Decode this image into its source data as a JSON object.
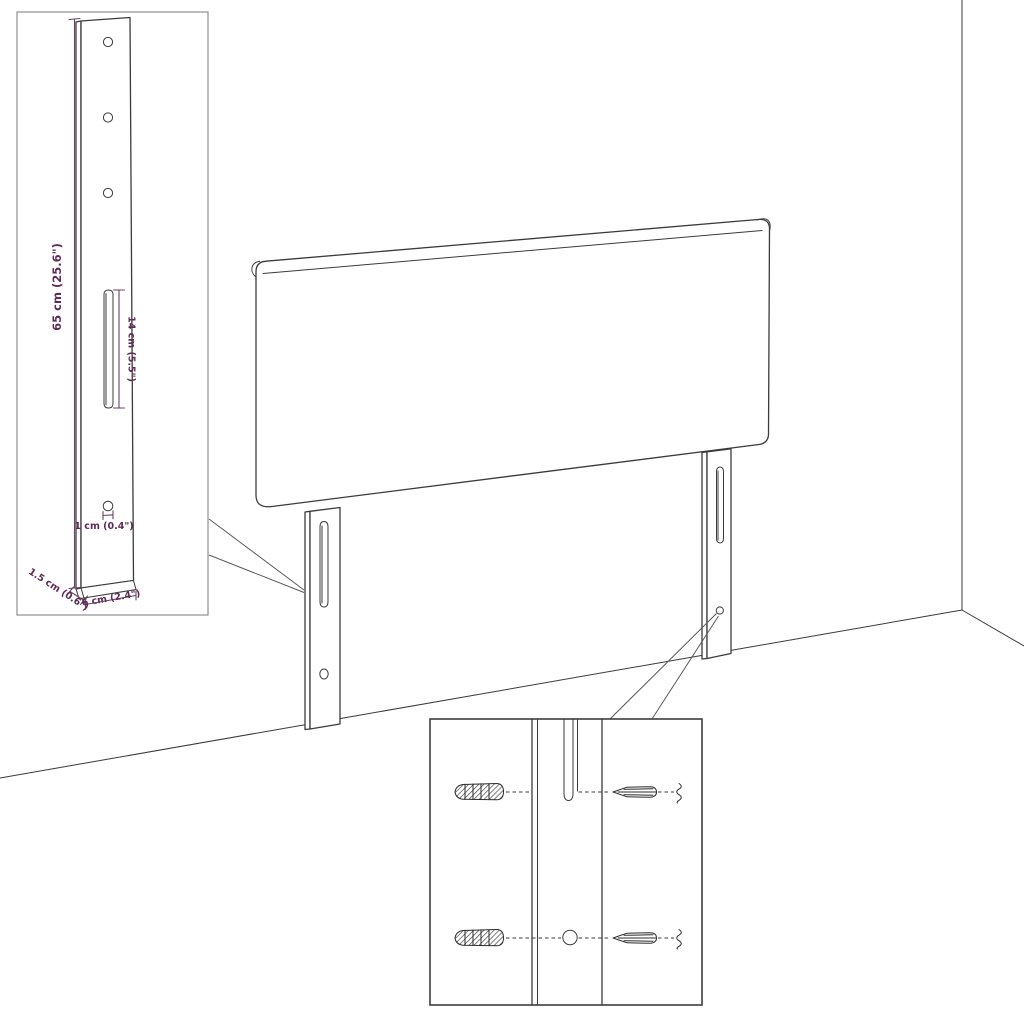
{
  "diagram": {
    "type": "furniture-assembly-dimension-diagram",
    "subject": "headboard with two mounting legs shown against a room corner"
  },
  "dimensions": {
    "height_label": "65 cm (25.6\")",
    "slot_label": "14 cm (5.5\")",
    "hole_label": "1 cm (0.4\")",
    "depth_label": "1.5 cm (0.6\")",
    "width_label": "6 cm (2.4\")"
  },
  "colors": {
    "outline": "#3b3b3b",
    "dimension_text": "#5d2c56",
    "inset_border": "#8f8f8f",
    "background": "#ffffff"
  }
}
